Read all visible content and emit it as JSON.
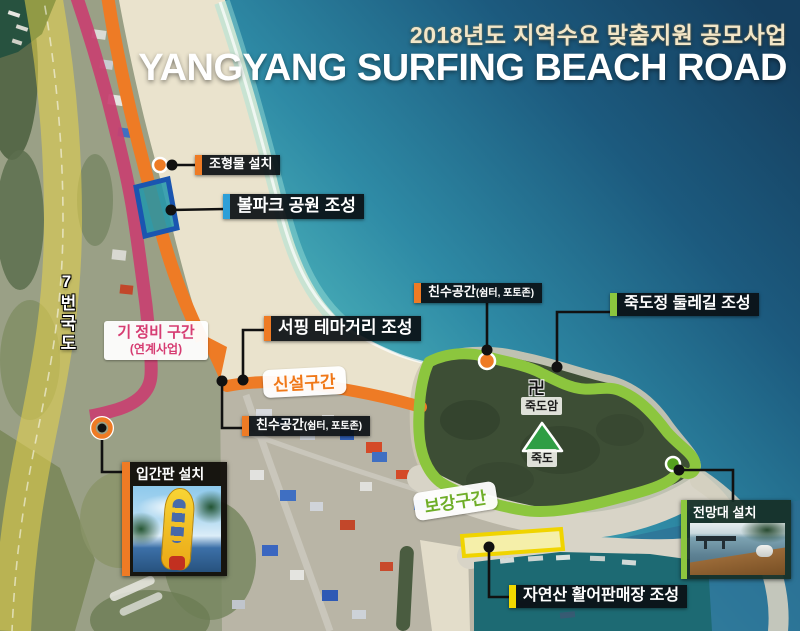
{
  "header": {
    "subtitle": "2018년도 지역수요 맞춤지원 공모사업",
    "title": "YANGYANG SURFING BEACH ROAD"
  },
  "road_label": "7번국도",
  "route_tags": {
    "existing": {
      "line1": "기 정비 구간",
      "line2": "(연계사업)"
    },
    "new_section": "신설구간",
    "reinforce_section": "보강구간"
  },
  "callouts": {
    "sculpture": "조형물 설치",
    "ballpark": "볼파크 공원 조성",
    "surfing_street": "서핑 테마거리 조성",
    "waterfront_upper": {
      "main": "친수공간",
      "sub": "(쉼터, 포토존)"
    },
    "waterfront_lower": {
      "main": "친수공간",
      "sub": "(쉼터, 포토존)"
    },
    "dulle_trail": "죽도정 둘레길 조성",
    "signboard": "입간판 설치",
    "observatory": "전망대 설치",
    "fish_market": "자연산 활어판매장 조성"
  },
  "poi": {
    "temple_symbol": "卍",
    "temple": "죽도암",
    "island": "죽도"
  },
  "colors": {
    "accent_orange": "#EE7B25",
    "accent_blue": "#2D9FD8",
    "accent_green": "#8CC63E",
    "accent_yellow": "#F2D900",
    "route_existing_magenta": "#C84071",
    "route_new_orange": "#EE7B25",
    "trail_green": "#8CC63E",
    "road_yellow": "#E9D54A",
    "tag_new_text": "#F07818",
    "tag_reinforce_text": "#6FAE28",
    "tag_existing_text": "#D63C72",
    "title_white": "#FFFFFF",
    "subtitle_cream": "#F2E6C8",
    "ballpark_fill": "#2096AA",
    "ballpark_border": "#1A55B0",
    "fishmarket_fill": "#F5EFA9"
  }
}
